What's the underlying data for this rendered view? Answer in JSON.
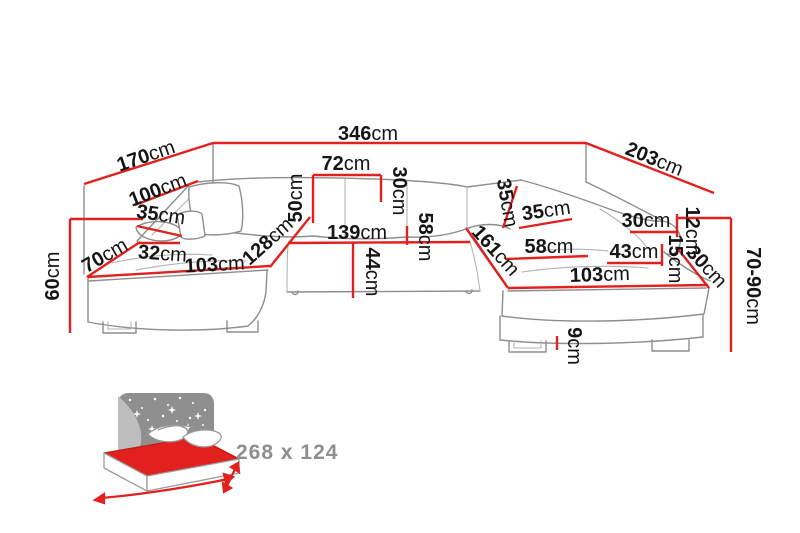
{
  "diagram": {
    "dimensions": [
      {
        "name": "total-width",
        "value": "346",
        "unit": "cm"
      },
      {
        "name": "left-back-width",
        "value": "170",
        "unit": "cm"
      },
      {
        "name": "right-back-width",
        "value": "203",
        "unit": "cm"
      },
      {
        "name": "left-armrest-length",
        "value": "100",
        "unit": "cm"
      },
      {
        "name": "left-armrest-pad",
        "value": "35",
        "unit": "cm"
      },
      {
        "name": "left-front-width",
        "value": "70",
        "unit": "cm"
      },
      {
        "name": "left-seat-offset",
        "value": "32",
        "unit": "cm"
      },
      {
        "name": "left-chaise-length",
        "value": "103",
        "unit": "cm"
      },
      {
        "name": "left-height",
        "value": "60",
        "unit": "cm"
      },
      {
        "name": "backrest-seat-height",
        "value": "50",
        "unit": "cm"
      },
      {
        "name": "back-cushion-width",
        "value": "72",
        "unit": "cm"
      },
      {
        "name": "back-cushion-height",
        "value": "30",
        "unit": "cm"
      },
      {
        "name": "middle-seat-width",
        "value": "139",
        "unit": "cm"
      },
      {
        "name": "middle-seat-depth",
        "value": "58",
        "unit": "cm"
      },
      {
        "name": "middle-front-depth",
        "value": "44",
        "unit": "cm"
      },
      {
        "name": "left-chaise-diagonal",
        "value": "128",
        "unit": "cm"
      },
      {
        "name": "right-chaise-diagonal",
        "value": "161",
        "unit": "cm"
      },
      {
        "name": "right-backrest-height",
        "value": "35",
        "unit": "cm"
      },
      {
        "name": "right-backrest-depth",
        "value": "35",
        "unit": "cm"
      },
      {
        "name": "right-armrest-top",
        "value": "30",
        "unit": "cm"
      },
      {
        "name": "right-armrest-edge",
        "value": "12",
        "unit": "cm"
      },
      {
        "name": "right-armrest-front",
        "value": "15",
        "unit": "cm"
      },
      {
        "name": "right-seat-depth",
        "value": "58",
        "unit": "cm"
      },
      {
        "name": "right-seat-front",
        "value": "43",
        "unit": "cm"
      },
      {
        "name": "right-chaise-length",
        "value": "103",
        "unit": "cm"
      },
      {
        "name": "right-corner-diagonal",
        "value": "30",
        "unit": "cm"
      },
      {
        "name": "seat-height-range",
        "value": "70-90",
        "unit": "cm"
      },
      {
        "name": "leg-height",
        "value": "9",
        "unit": "cm"
      }
    ],
    "bed_icon": {
      "size_label": "268 x 124"
    },
    "colors": {
      "dimension_line": "#e2201d",
      "label": "#151515",
      "sofa_outline": "#8e8e8e",
      "icon_gray": "#8f8f8f"
    }
  }
}
